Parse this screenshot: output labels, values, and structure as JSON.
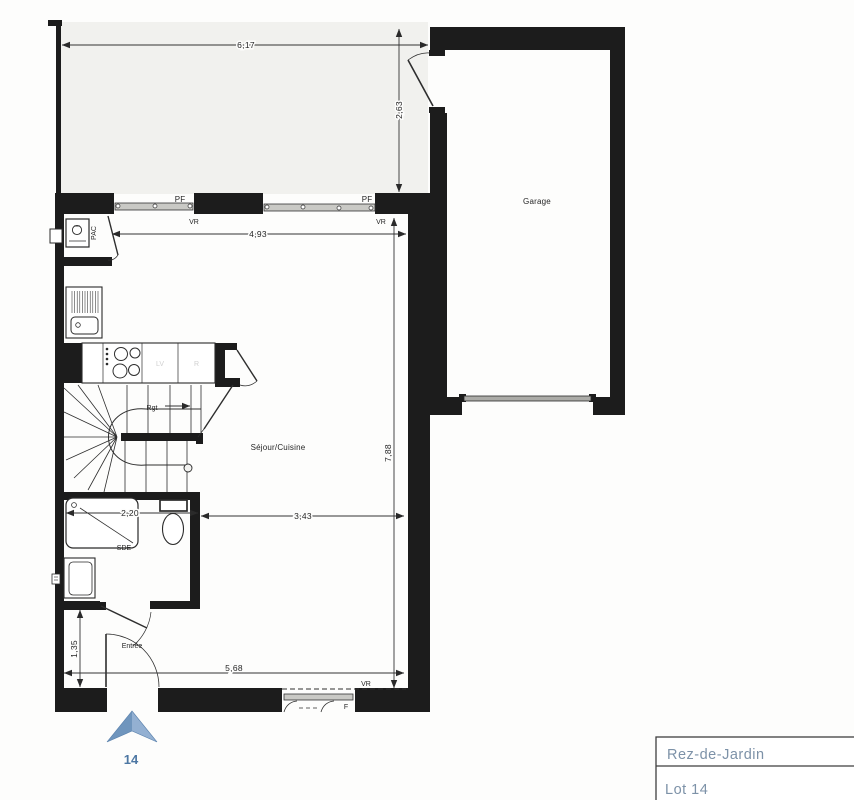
{
  "floor_plan": {
    "title_block": {
      "level": "Rez-de-Jardin",
      "lot": "Lot 14"
    },
    "lot_marker": "14",
    "rooms": {
      "garage": "Garage",
      "living_kitchen": "Séjour/Cuisine",
      "shower_room": "SDE",
      "entry": "Entrée",
      "heat_pump": "PAC",
      "storage_arrow": "Rgt"
    },
    "openings": {
      "pf_window_left": "PF",
      "pf_window_right": "PF",
      "vr_shutter_left": "VR",
      "vr_shutter_right": "VR",
      "vr_shutter_bottom": "VR",
      "f_window_bottom": "F"
    },
    "kitchen_appliances": {
      "dishwasher": "LV",
      "fridge": "R"
    },
    "dimensions": {
      "terrace_width": "6,17",
      "terrace_depth": "2,63",
      "kitchen_width": "4,93",
      "living_depth": "7,88",
      "shower_width": "2,20",
      "living_width": "3,43",
      "ground_width": "5,68",
      "entry_depth": "1,35"
    },
    "colors": {
      "wall": "#1c1c1c",
      "terrace_fill": "#f1f1ee",
      "accent_text": "#7d92a8",
      "marker_blue": "#7fa2c7"
    }
  }
}
